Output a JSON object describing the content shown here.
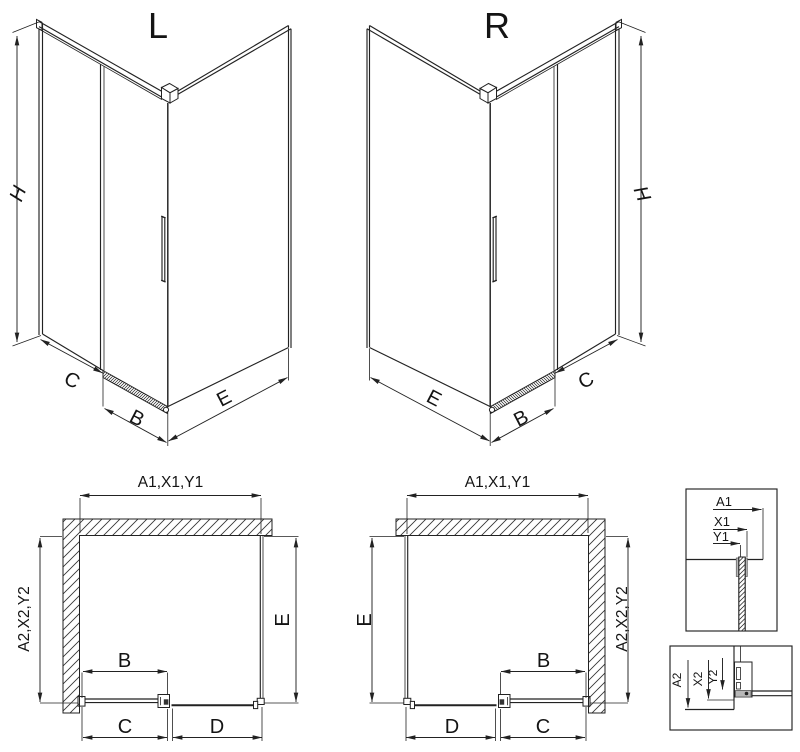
{
  "drawing": {
    "iso_left": {
      "title": "L",
      "height_label": "H",
      "fixed_label": "C",
      "door_label": "B",
      "side_label": "E"
    },
    "iso_right": {
      "title": "R",
      "height_label": "H",
      "fixed_label": "C",
      "door_label": "B",
      "side_label": "E"
    },
    "plan_left": {
      "top_label": "A1,X1,Y1",
      "wall_label": "A2,X2,Y2",
      "side_label": "E",
      "door_label": "B",
      "fixed_label": "C",
      "opening_label": "D"
    },
    "plan_right": {
      "top_label": "A1,X1,Y1",
      "wall_label": "A2,X2,Y2",
      "side_label": "E",
      "door_label": "B",
      "fixed_label": "C",
      "opening_label": "D"
    },
    "detail_top": {
      "labels": [
        "A1",
        "X1",
        "Y1"
      ]
    },
    "detail_bottom": {
      "labels": [
        "A2",
        "X2",
        "Y2"
      ]
    },
    "colors": {
      "line": "#222222",
      "profile_gray": "#b9b9b9",
      "background": "#ffffff"
    }
  }
}
